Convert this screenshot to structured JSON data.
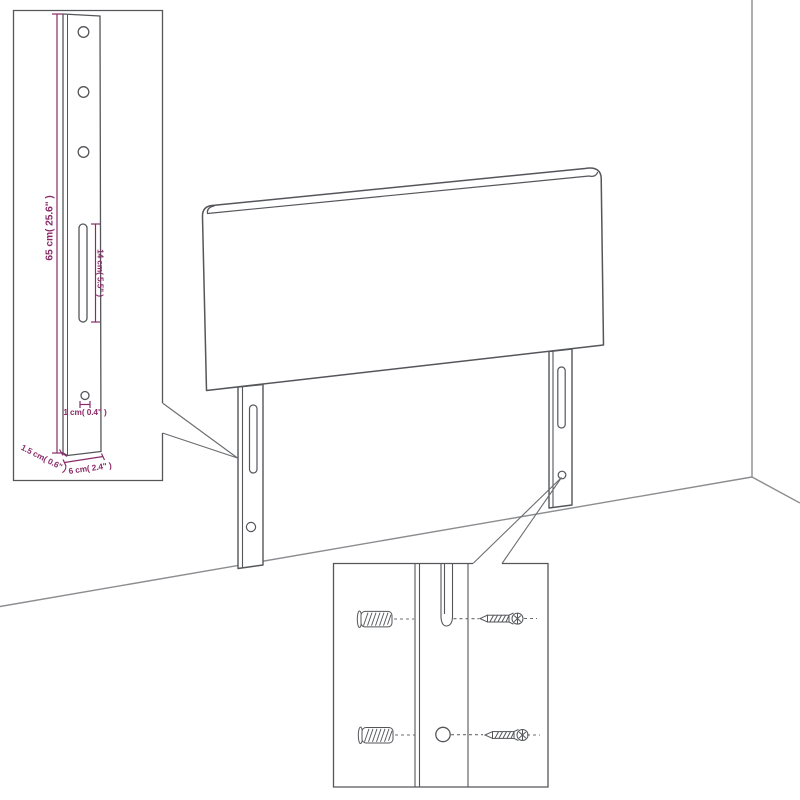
{
  "colors": {
    "line_art": "#54565a",
    "wall_line": "#8b8d90",
    "dimension_accent": "#8a2b69",
    "background": "#ffffff"
  },
  "leg_detail_callout": {
    "dims": {
      "height": "65 cm( 25.6\" )",
      "slot_length": "14 cm( 5.5\" )",
      "hole_diameter": "1 cm( 0.4\" )",
      "side_thickness": "1.5 cm( 0.6\" )",
      "leg_width": "6 cm( 2.4\" )"
    }
  },
  "mounting_detail_callout": {
    "icons": [
      "wall-plug-icon",
      "screw-icon",
      "wall-plug-icon",
      "screw-icon"
    ]
  }
}
